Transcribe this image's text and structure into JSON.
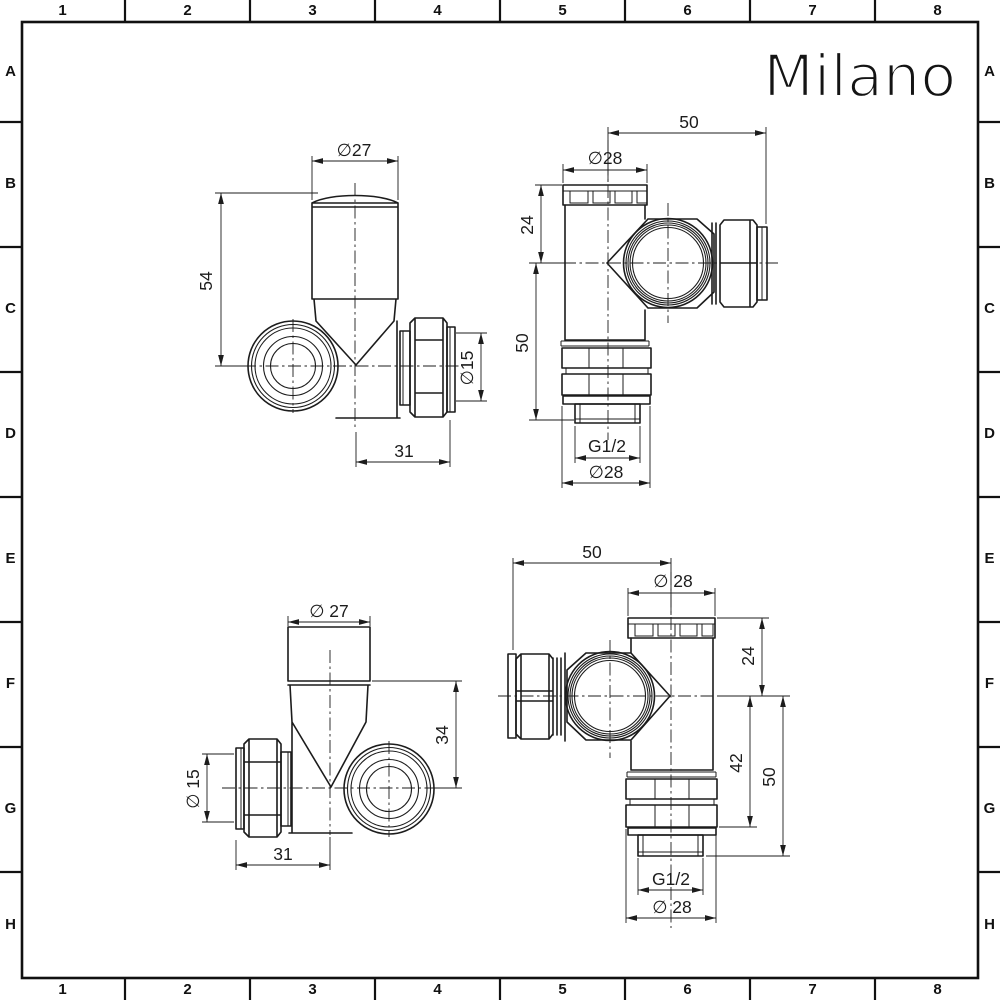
{
  "frame": {
    "cols": [
      "1",
      "2",
      "3",
      "4",
      "5",
      "6",
      "7",
      "8"
    ],
    "rows": [
      "A",
      "B",
      "C",
      "D",
      "E",
      "F",
      "G",
      "H"
    ]
  },
  "logo": {
    "text": "Milano"
  },
  "colors": {
    "ink": "#1c1c1c",
    "paper": "#ffffff"
  },
  "views": {
    "top_left": {
      "dims": {
        "head_dia": "∅27",
        "height": "54",
        "outlet_dia": "∅15",
        "offset": "31"
      }
    },
    "top_right": {
      "dims": {
        "depth": "50",
        "cap_dia": "∅28",
        "cap_to_axis": "24",
        "axis_to_thread": "50",
        "thread": "G1/2",
        "body_dia": "∅28"
      }
    },
    "bottom_left": {
      "dims": {
        "head_dia": "∅ 27",
        "rim_to_axis": "34",
        "outlet_dia": "∅ 15",
        "offset": "31"
      }
    },
    "bottom_right": {
      "dims": {
        "depth": "50",
        "cap_dia": "∅ 28",
        "cap_to_axis": "24",
        "axis_to_nut": "42",
        "axis_to_thread": "50",
        "thread": "G1/2",
        "body_dia": "∅ 28"
      }
    }
  }
}
